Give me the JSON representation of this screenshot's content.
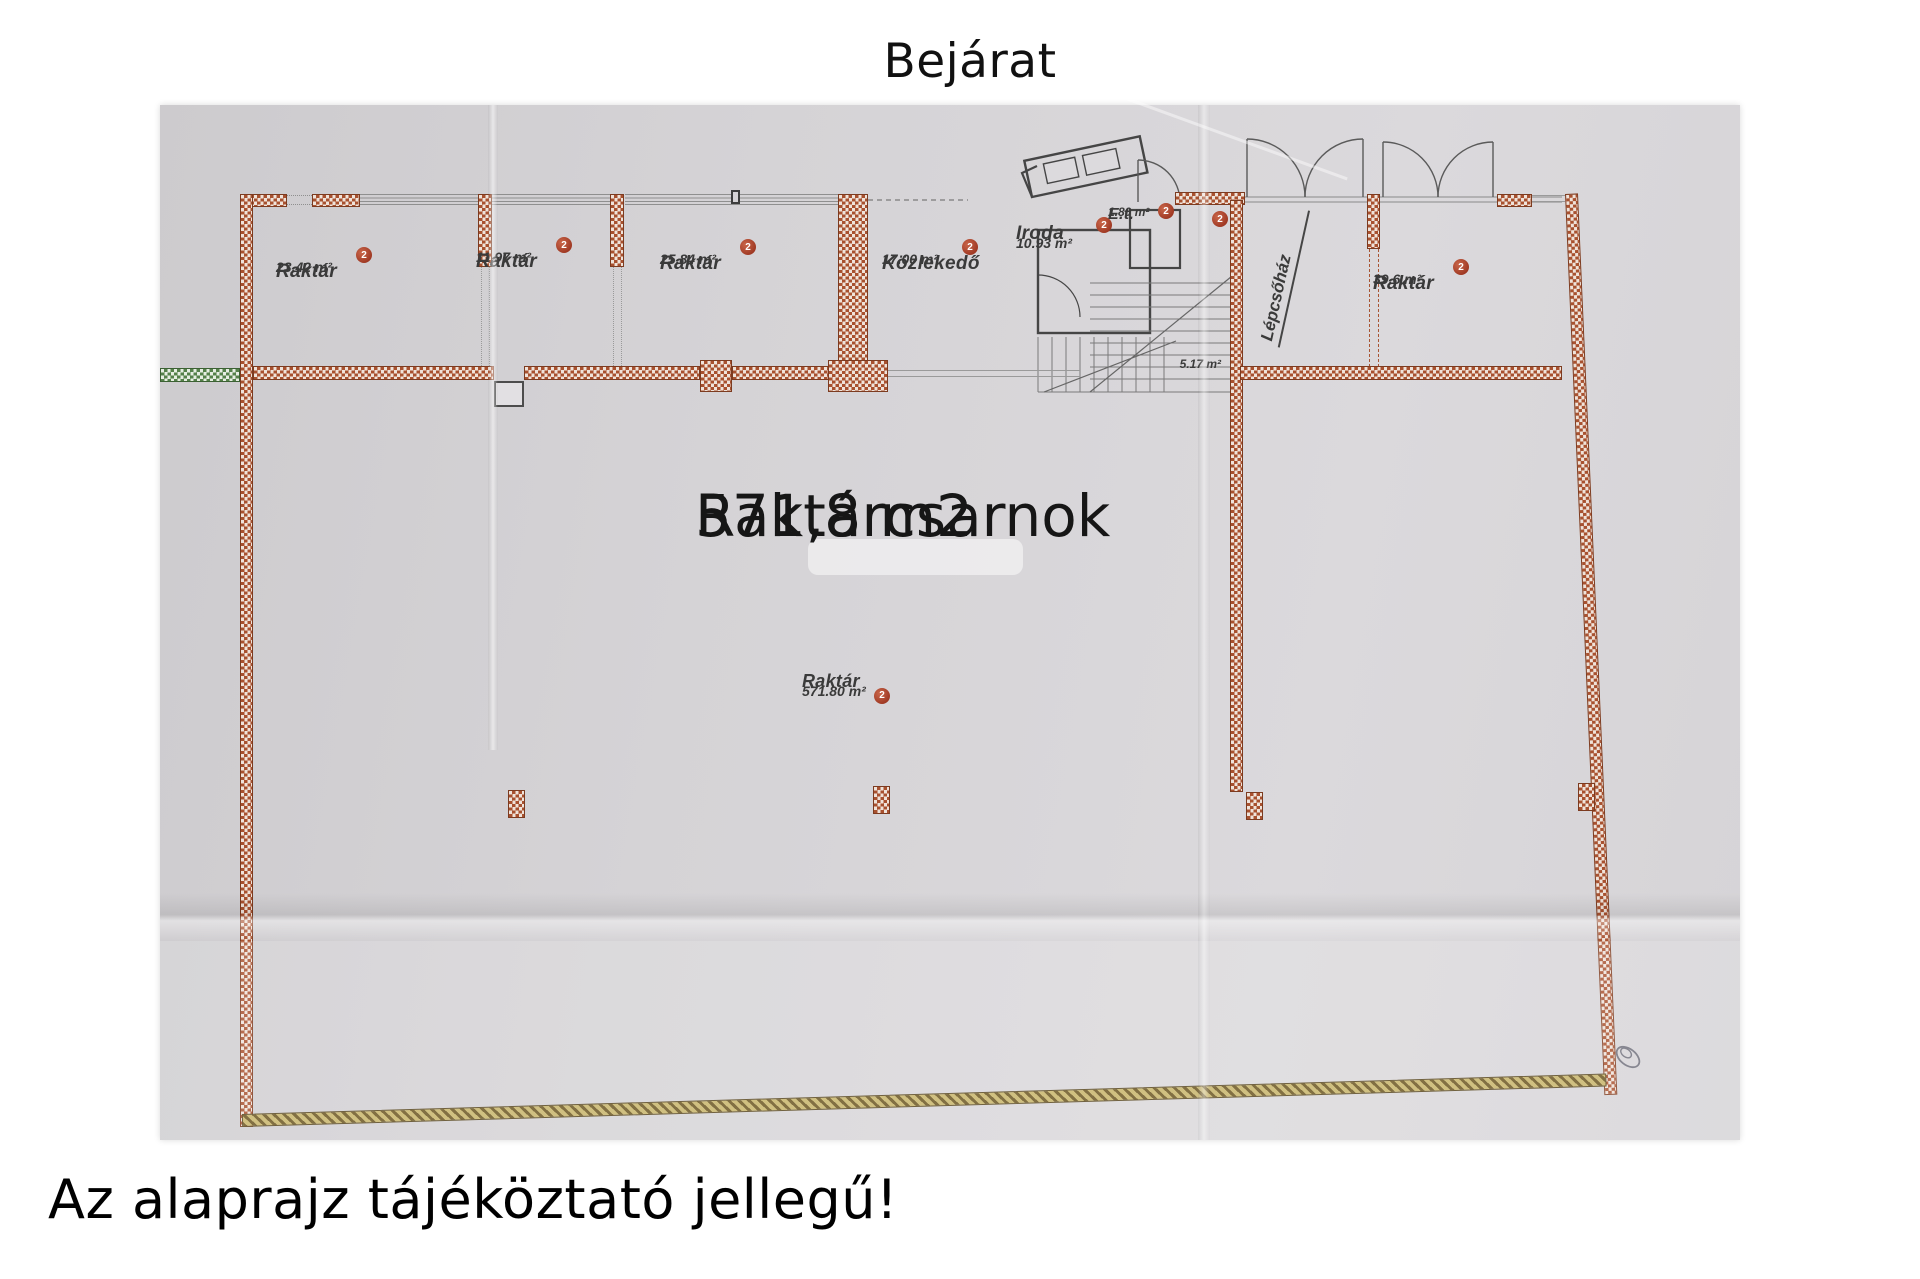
{
  "title": "Bejárat",
  "footer_note": "Az alaprajz tájéköztató jellegű!",
  "hall": {
    "title": "Raktárcsarnok",
    "area_big": "571,8 m2"
  },
  "rooms": {
    "raktar1": {
      "marker": "2",
      "name": "Raktár",
      "area": "23.42 m²"
    },
    "raktar2": {
      "marker": "2",
      "name": "Raktár",
      "area": "11.97 m²"
    },
    "raktar3": {
      "marker": "2",
      "name": "Raktár",
      "area": "25.84 m²"
    },
    "kozlekedo": {
      "marker": "2",
      "name": "Közlekedő",
      "area": "17.00 m²"
    },
    "iroda": {
      "marker": "2",
      "name": "Iroda",
      "area": "10.93 m²"
    },
    "et": {
      "marker": "2",
      "name": "E.t.",
      "area": "1.80 m²"
    },
    "lepcsohaz": {
      "marker": "2",
      "name": "Lépcsőház",
      "area": "5.17 m²"
    },
    "raktar4": {
      "marker": "2",
      "name": "Raktár",
      "area": "39.6 m²"
    },
    "hall_label": {
      "marker": "2",
      "name": "Raktár",
      "area": "571.80 m²"
    }
  },
  "colors": {
    "wall_red": "#a8512f",
    "wall_green": "#55814a",
    "wall_gold": "#6b5520",
    "marker_red": "#9c3520",
    "paper": "#d4d2d5"
  }
}
